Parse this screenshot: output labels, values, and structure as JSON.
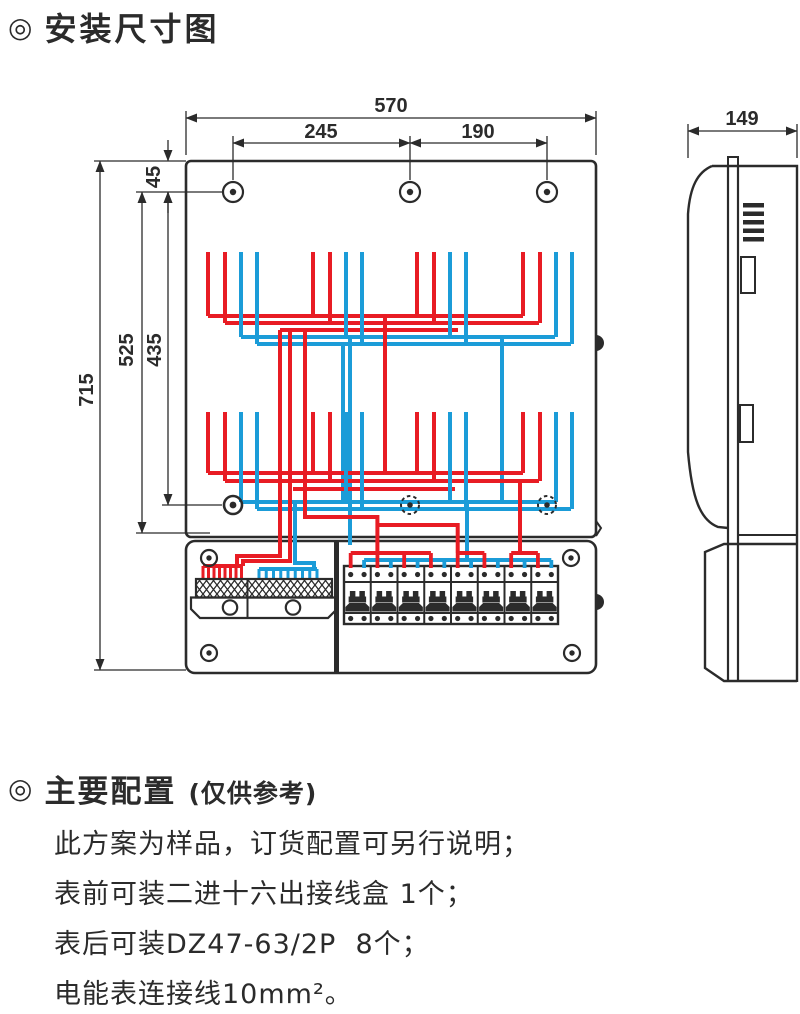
{
  "colors": {
    "outline": "#2b2b2b",
    "wire_red": "#e81c24",
    "wire_blue": "#1b9cd8"
  },
  "install_section": {
    "bullet": "◎",
    "title": "安装尺寸图"
  },
  "dimensions": {
    "top_width": "570",
    "hole_span_left": "245",
    "hole_span_right": "190",
    "hole_top_offset": "45",
    "height_total": "715",
    "height_to_bottom_plate": "525",
    "height_to_lower_holes": "435",
    "side_depth": "149"
  },
  "diagram": {
    "meter_columns": 4,
    "meter_rows": 2,
    "breaker_count": 8,
    "terminal_red_stubs": 8,
    "terminal_blue_stubs": 9
  },
  "config_section": {
    "bullet": "◎",
    "title": "主要配置",
    "note": "(仅供参考)",
    "lines": [
      "此方案为样品，订货配置可另行说明；",
      "表前可装二进十六出接线盒 1个；",
      "表后可装DZ47-63/2P  8个；",
      "电能表连接线10mm²。"
    ]
  }
}
